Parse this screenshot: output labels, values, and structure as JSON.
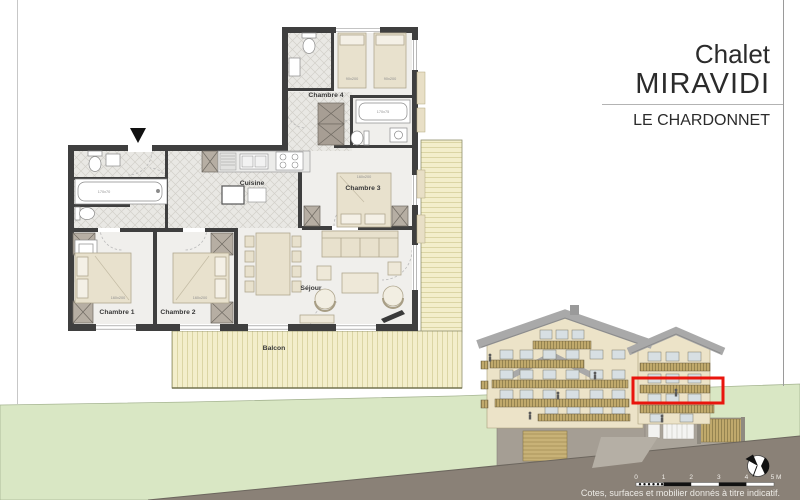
{
  "title_block": {
    "prefix": "Chalet",
    "name": "MIRAVIDI",
    "residence": "LE CHARDONNET"
  },
  "floor_plan": {
    "rooms": {
      "chambre1": "Chambre 1",
      "chambre2": "Chambre 2",
      "chambre3": "Chambre 3",
      "chambre4": "Chambre 4",
      "cuisine": "Cuisine",
      "sejour": "Séjour",
      "balcon": "Balcon"
    },
    "dimensions": {
      "bed_chambre1": "160x200",
      "bed_chambre2": "160x200",
      "bed_chambre3": "160x200",
      "bed_chambre4_left": "90x200",
      "bed_chambre4_right": "90x200",
      "bathtub_main": "170x70",
      "bathtub_chambre4": "170x75"
    }
  },
  "scale_bar": {
    "ticks": [
      "0",
      "1",
      "2",
      "3",
      "4",
      "5 M"
    ]
  },
  "footer": {
    "disclaimer": "Cotes, surfaces et mobilier donnés à titre indicatif."
  },
  "colors": {
    "highlight_red": "#e9150d",
    "facade_cream": "#ece3c8",
    "roof_gray": "#a9a9a9",
    "balcony_wood": "#c0a96c",
    "ground_green": "#d9e7c4",
    "road_gray": "#8a8177",
    "wall_dark": "#3f3f3f",
    "deck_wood": "#f3eecb"
  }
}
